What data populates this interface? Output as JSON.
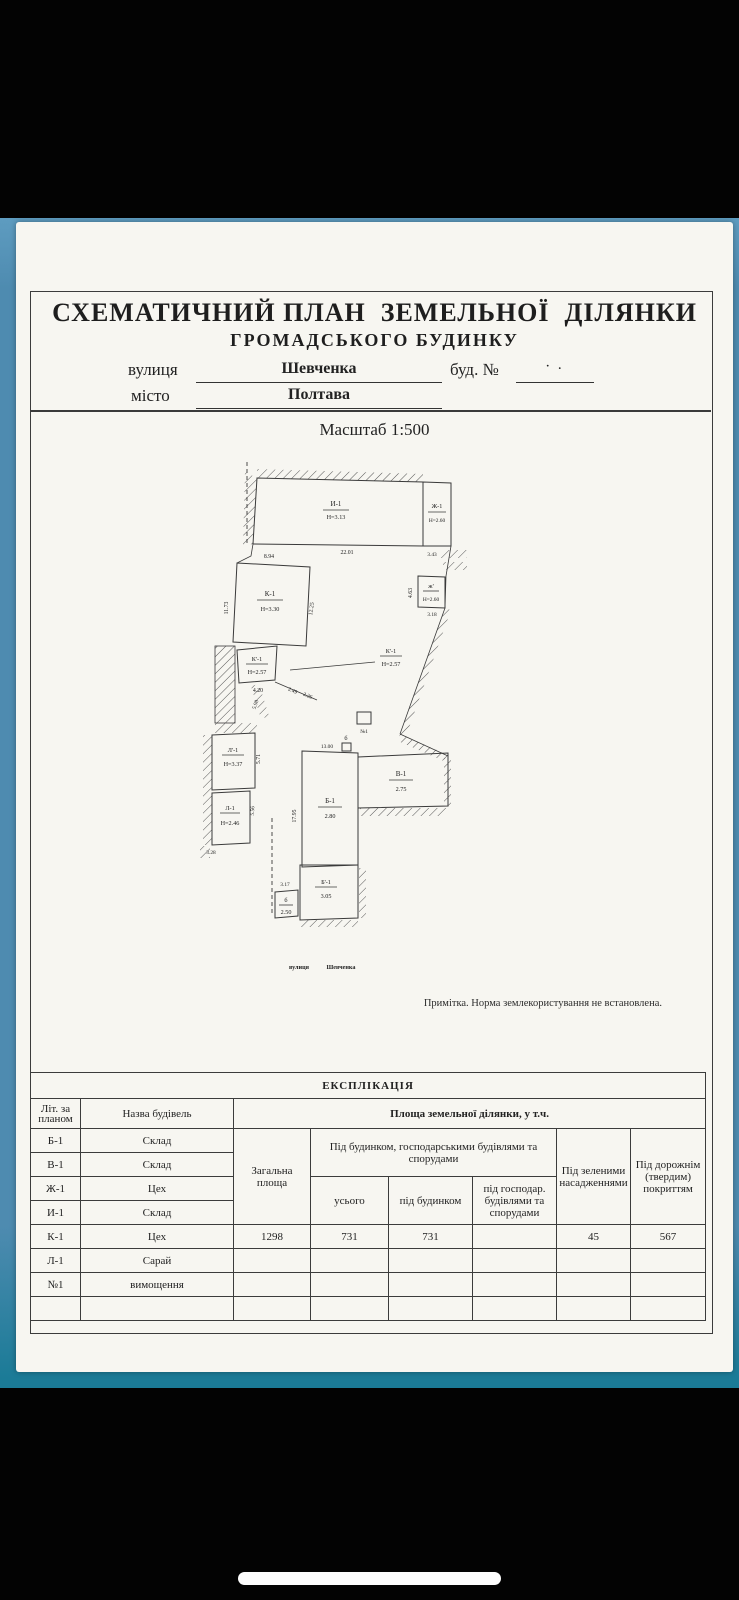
{
  "document": {
    "title_line1": "СХЕМАТИЧНИЙ ПЛАН  ЗЕМЕЛЬНОЇ  ДІЛЯНКИ",
    "title_line2": "ГРОМАДСЬКОГО БУДИНКУ",
    "fields": {
      "street_label": "вулиця",
      "street_value": "Шевченка",
      "building_label": "буд. №",
      "building_value": "· .",
      "city_label": "місто",
      "city_value": "Полтава"
    },
    "scale": "Масштаб 1:500",
    "note": "Примітка.  Норма землекористування не встановлена."
  },
  "plan": {
    "street_caption_1": "вулиця",
    "street_caption_2": "Шевченка",
    "b": {
      "i1": {
        "name": "И-1",
        "h": "Н=3.13"
      },
      "zh1": {
        "name": "Ж-1",
        "h": "Н=2.60"
      },
      "k1": {
        "name": "К-1",
        "h": "Н=3.30"
      },
      "zhp": {
        "name": "ж'",
        "h": "Н=2.60"
      },
      "kp1a": {
        "name": "К'-1",
        "h": "Н=2.57"
      },
      "kp1b": {
        "name": "К'-1",
        "h": "Н=2.57"
      },
      "lp1": {
        "name": "Л'-1",
        "h": "Н=3.37"
      },
      "l1": {
        "name": "Л-1",
        "h": "Н=2.46"
      },
      "b1": {
        "name": "Б-1",
        "h": "2.80"
      },
      "v1": {
        "name": "В-1",
        "h": "2.75"
      },
      "bp1": {
        "name": "Б'-1",
        "h": "3.05"
      },
      "b_small": {
        "name": "б",
        "h": "2.50"
      },
      "b_top": "б",
      "n1": "№1"
    },
    "dims": {
      "d2201": "22.01",
      "d343": "3.43",
      "d894": "8.94",
      "d1173": "11.73",
      "d1225": "12.25",
      "d463": "4.63",
      "d318": "3.18",
      "d420": "4.20",
      "d249": "2.49",
      "d226": "2.26",
      "d598": "5.98",
      "d571": "5.71",
      "d556": "5.56",
      "d328": "3.28",
      "d1300": "13.00",
      "d1795": "17.95",
      "d317": "3.17"
    }
  },
  "table": {
    "title": "ЕКСПЛІКАЦІЯ",
    "headers": {
      "lit": "Літ. за планом",
      "name": "Назва будівель",
      "area_group": "Площа земельної ділянки,  у т.ч.",
      "total": "Загальна площа",
      "under_buildings_group": "Під будинком, господарськими будівлями та спорудами",
      "total_sub": "усього",
      "under_house": "під будинком",
      "under_household": "під господар. будівлями та спорудами",
      "green": "Під зеленими насадженнями",
      "road": "Під дорожнім (твердим) покриттям"
    },
    "rows": [
      {
        "lit": "Б-1",
        "name": "Склад",
        "c1": "",
        "c2": "",
        "c3": "",
        "c4": "",
        "c5": "",
        "c6": ""
      },
      {
        "lit": "В-1",
        "name": "Склад",
        "c1": "",
        "c2": "",
        "c3": "",
        "c4": "",
        "c5": "",
        "c6": ""
      },
      {
        "lit": "Ж-1",
        "name": "Цех",
        "c1": "",
        "c2": "",
        "c3": "",
        "c4": "",
        "c5": "",
        "c6": ""
      },
      {
        "lit": "И-1",
        "name": "Склад",
        "c1": "",
        "c2": "",
        "c3": "",
        "c4": "",
        "c5": "",
        "c6": ""
      },
      {
        "lit": "К-1",
        "name": "Цех",
        "c1": "1298",
        "c2": "731",
        "c3": "731",
        "c4": "",
        "c5": "45",
        "c6": "567"
      },
      {
        "lit": "Л-1",
        "name": "Сарай",
        "c1": "",
        "c2": "",
        "c3": "",
        "c4": "",
        "c5": "",
        "c6": ""
      },
      {
        "lit": "№1",
        "name": "вимощення",
        "c1": "",
        "c2": "",
        "c3": "",
        "c4": "",
        "c5": "",
        "c6": ""
      },
      {
        "lit": "",
        "name": "",
        "c1": "",
        "c2": "",
        "c3": "",
        "c4": "",
        "c5": "",
        "c6": ""
      }
    ]
  }
}
